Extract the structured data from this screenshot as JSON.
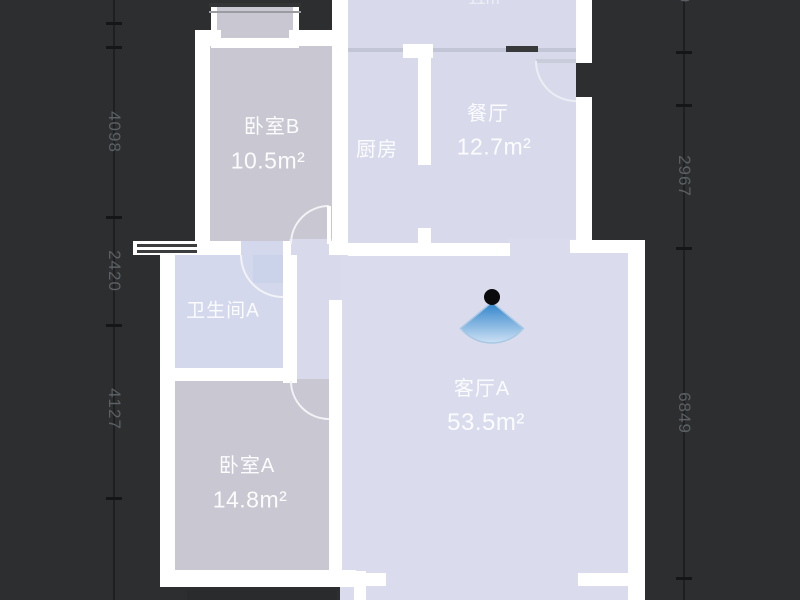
{
  "app": {
    "type": "floorplan-viewer"
  },
  "colors": {
    "background": "#2c2e2f",
    "wall": "#ffffff",
    "room_light": "#d8daec",
    "room_dark": "#c9c7d1",
    "bathroom": "#d4d8ec",
    "living": "#dadcee",
    "label_text": "#fbfcfe",
    "dimension_text": "#5c6064",
    "camera_blue": "#2d82ca",
    "camera_blue_light": "#cde1f4"
  },
  "rooms": {
    "bedroom_b": {
      "name": "卧室B",
      "area": "10.5m²"
    },
    "kitchen": {
      "name": "厨房"
    },
    "dining": {
      "name": "餐厅",
      "area": "12.7m²"
    },
    "bathroom_a": {
      "name": "卫生间A"
    },
    "bedroom_a": {
      "name": "卧室A",
      "area": "14.8m²"
    },
    "living_a": {
      "name": "客厅A",
      "area": "53.5m²"
    },
    "clipped_top": {
      "label": "11m"
    }
  },
  "dimensions": {
    "left": [
      {
        "value": "4098"
      },
      {
        "value": "2420"
      },
      {
        "value": "4127"
      }
    ],
    "right": [
      {
        "value": "9"
      },
      {
        "value": "2967"
      },
      {
        "value": "6849"
      }
    ]
  }
}
